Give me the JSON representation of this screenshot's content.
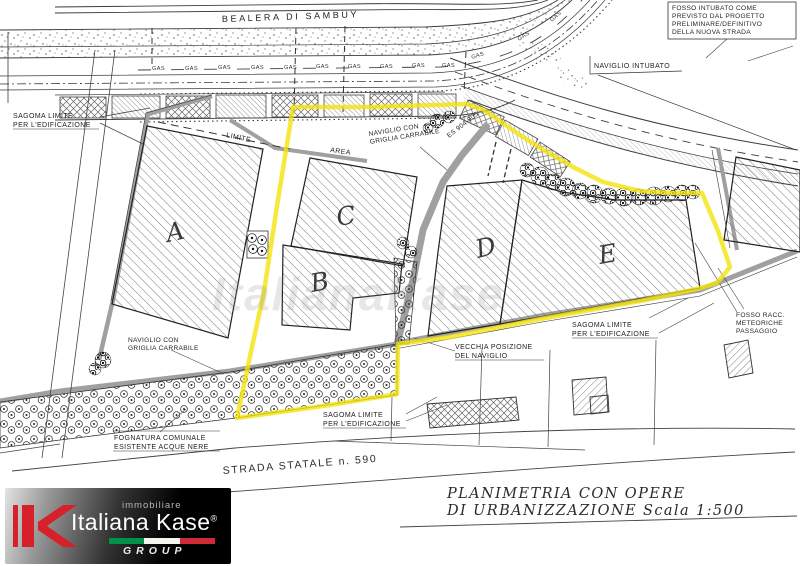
{
  "image": {
    "width": 800,
    "height": 566,
    "kind": "scanned urbanization site plan"
  },
  "plan": {
    "labels": {
      "bealera": "BEALERA DI SAMBUY",
      "fosso_box_lines": [
        "FOSSO INTUBATO COME",
        "PREVISTO DAL PROGETTO",
        "PRELIMINARE/DEFINITIVO",
        "DELLA NUOVA STRADA"
      ],
      "naviglio_intubato": "NAVIGLIO INTUBATO",
      "sagoma_top_left": [
        "SAGOMA LIMITE",
        "PER L'EDIFICAZIONE"
      ],
      "limite": "LIMITE",
      "area": "AREA",
      "naviglio_griglia_top": [
        "NAVIGLIO CON",
        "GRIGLIA CARRABILE"
      ],
      "sezione": "ES 904-905",
      "naviglio_griglia_bottom": [
        "NAVIGLIO CON",
        "GRIGLIA CARRABILE"
      ],
      "sagoma_right": [
        "SAGOMA LIMITE",
        "PER L'EDIFICAZIONE"
      ],
      "vecchia_posizione": [
        "VECCHIA POSIZIONE",
        "DEL NAVIGLIO"
      ],
      "sagoma_bottom": [
        "SAGOMA LIMITE",
        "PER L'EDIFICAZIONE"
      ],
      "fognatura": [
        "FOGNATURA COMUNALE",
        "ESISTENTE ACQUE NERE"
      ],
      "fosso_racc": [
        "FOSSO RACC.",
        "METEORICHE",
        "PASSAGGIO"
      ],
      "strada_statale": "STRADA STATALE n. 590",
      "gas": "GAS"
    },
    "buildings": [
      "A",
      "B",
      "C",
      "D",
      "E"
    ],
    "title_block": [
      "PLANIMETRIA CON OPERE",
      "DI URBANIZZAZIONE Scala 1:500"
    ],
    "highlight_color": "#f2e30e"
  },
  "watermark": "ItalianaKase",
  "logo": {
    "tagline": "immobiliare",
    "name": "Italiana Kase",
    "registered": "®",
    "group": "GROUP",
    "brand_red": "#d6212b",
    "flag_green": "#009246",
    "flag_white": "#f4f5f0",
    "flag_red": "#ce2b37"
  }
}
